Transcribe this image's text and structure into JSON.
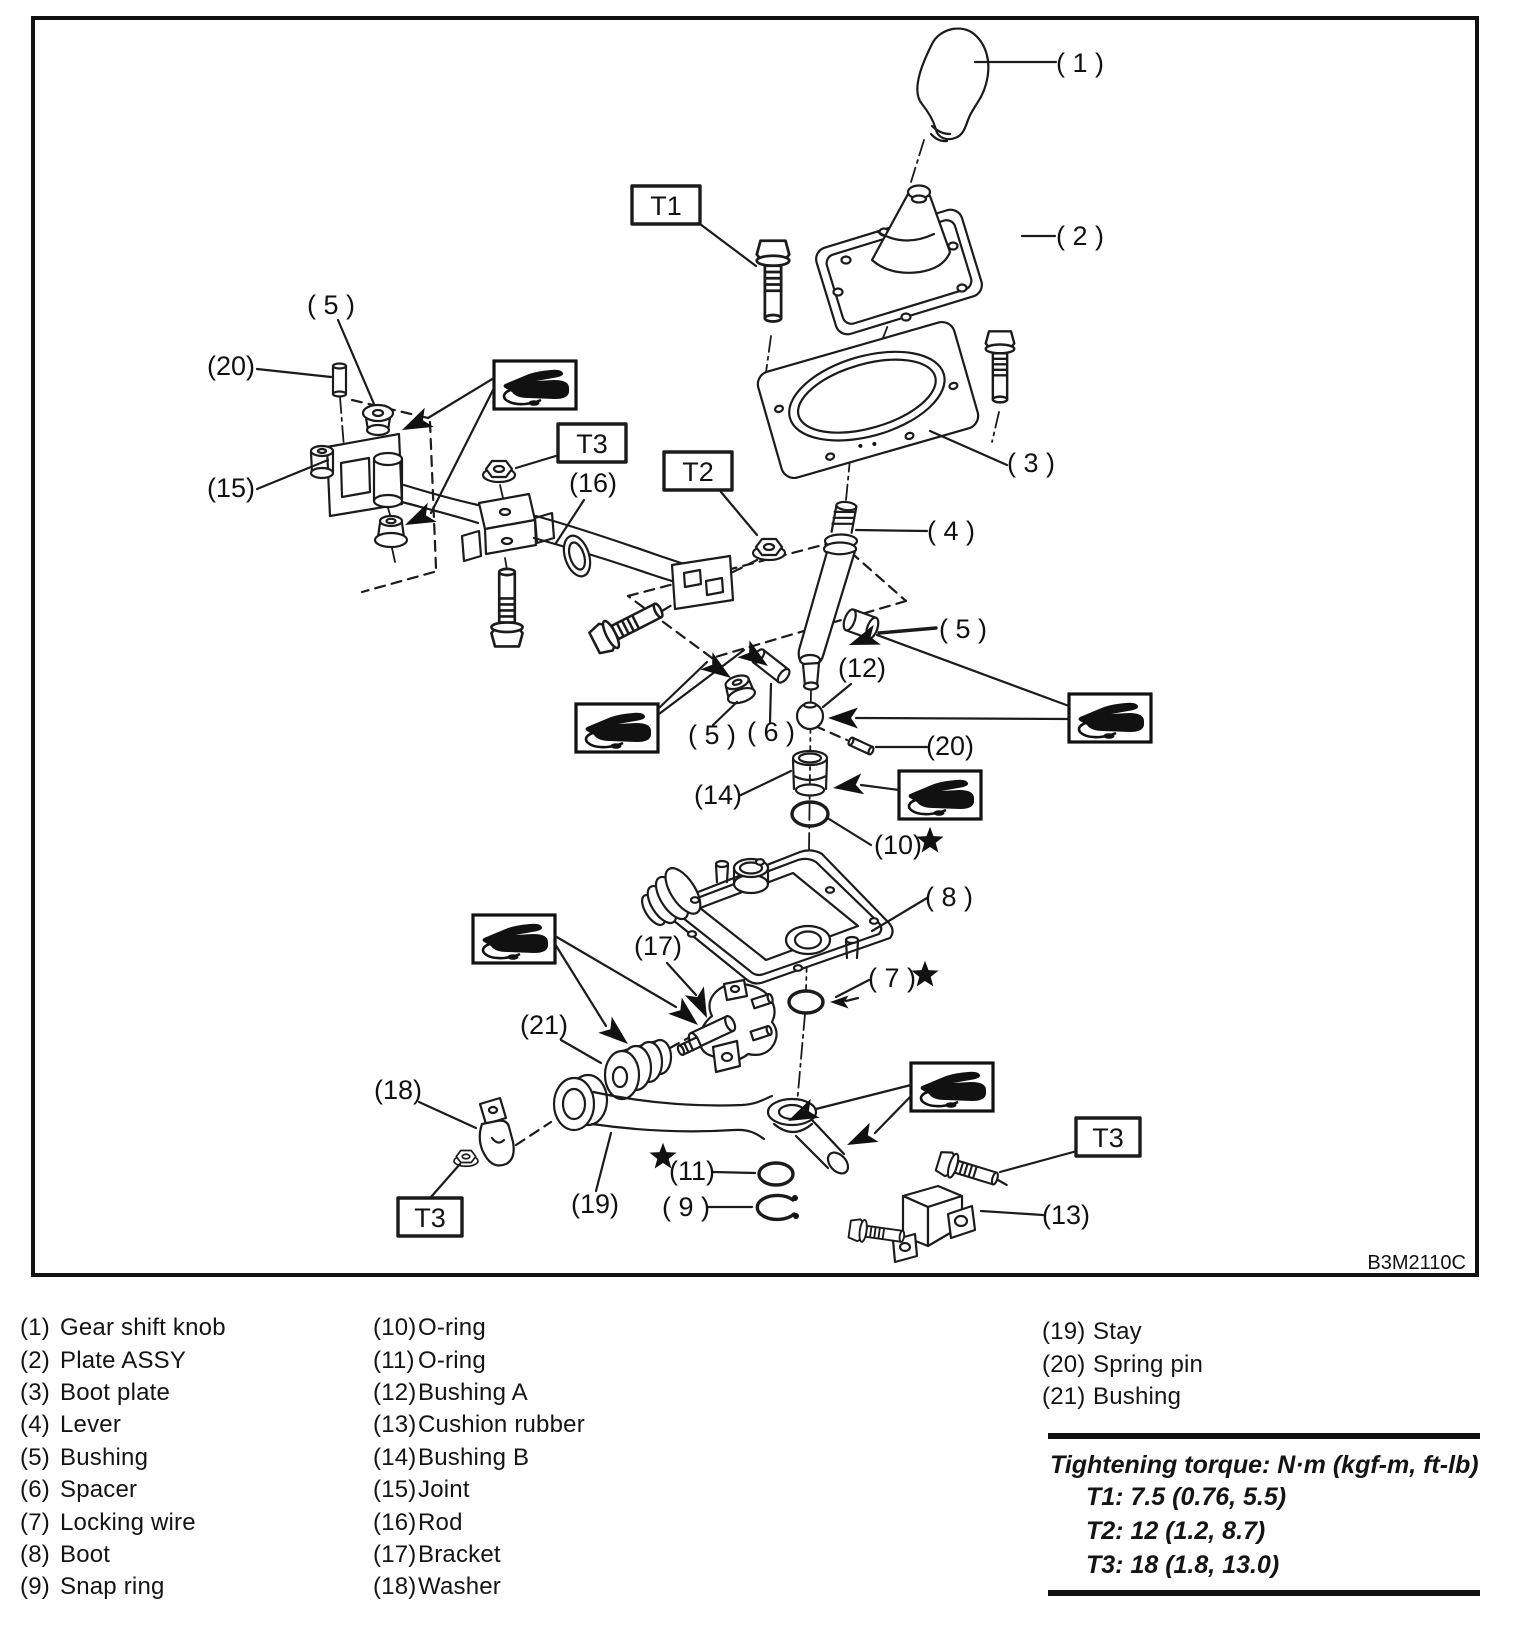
{
  "figure_code": "B3M2110C",
  "diagram": {
    "callouts": {
      "c1": "( 1 )",
      "c2": "( 2 )",
      "c3": "( 3 )",
      "c4": "( 4 )",
      "c5": "( 5 )",
      "c6": "( 6 )",
      "c7": "( 7 )",
      "c8": "( 8 )",
      "c9": "( 9 )",
      "c10": "(10)",
      "c11": "(11)",
      "c12": "(12)",
      "c13": "(13)",
      "c14": "(14)",
      "c15": "(15)",
      "c16": "(16)",
      "c17": "(17)",
      "c18": "(18)",
      "c19": "(19)",
      "c20": "(20)",
      "c21": "(21)",
      "t1": "T1",
      "t2": "T2",
      "t3": "T3"
    }
  },
  "legend": {
    "columns": [
      {
        "items": [
          {
            "num": "(1)",
            "label": "Gear shift knob"
          },
          {
            "num": "(2)",
            "label": "Plate ASSY"
          },
          {
            "num": "(3)",
            "label": "Boot plate"
          },
          {
            "num": "(4)",
            "label": "Lever"
          },
          {
            "num": "(5)",
            "label": "Bushing"
          },
          {
            "num": "(6)",
            "label": "Spacer"
          },
          {
            "num": "(7)",
            "label": "Locking wire"
          },
          {
            "num": "(8)",
            "label": "Boot"
          },
          {
            "num": "(9)",
            "label": "Snap ring"
          }
        ]
      },
      {
        "items": [
          {
            "num": "(10)",
            "label": "O-ring"
          },
          {
            "num": "(11)",
            "label": "O-ring"
          },
          {
            "num": "(12)",
            "label": "Bushing A"
          },
          {
            "num": "(13)",
            "label": "Cushion rubber"
          },
          {
            "num": "(14)",
            "label": "Bushing B"
          },
          {
            "num": "(15)",
            "label": "Joint"
          },
          {
            "num": "(16)",
            "label": "Rod"
          },
          {
            "num": "(17)",
            "label": "Bracket"
          },
          {
            "num": "(18)",
            "label": "Washer"
          }
        ]
      },
      {
        "items": [
          {
            "num": "(19)",
            "label": "Stay"
          },
          {
            "num": "(20)",
            "label": "Spring pin"
          },
          {
            "num": "(21)",
            "label": "Bushing"
          }
        ]
      }
    ]
  },
  "torque": {
    "title": "Tightening torque: N·m (kgf-m, ft-lb)",
    "rows": [
      "T1: 7.5 (0.76, 5.5)",
      "T2: 12 (1.2, 8.7)",
      "T3: 18 (1.8, 13.0)"
    ]
  }
}
